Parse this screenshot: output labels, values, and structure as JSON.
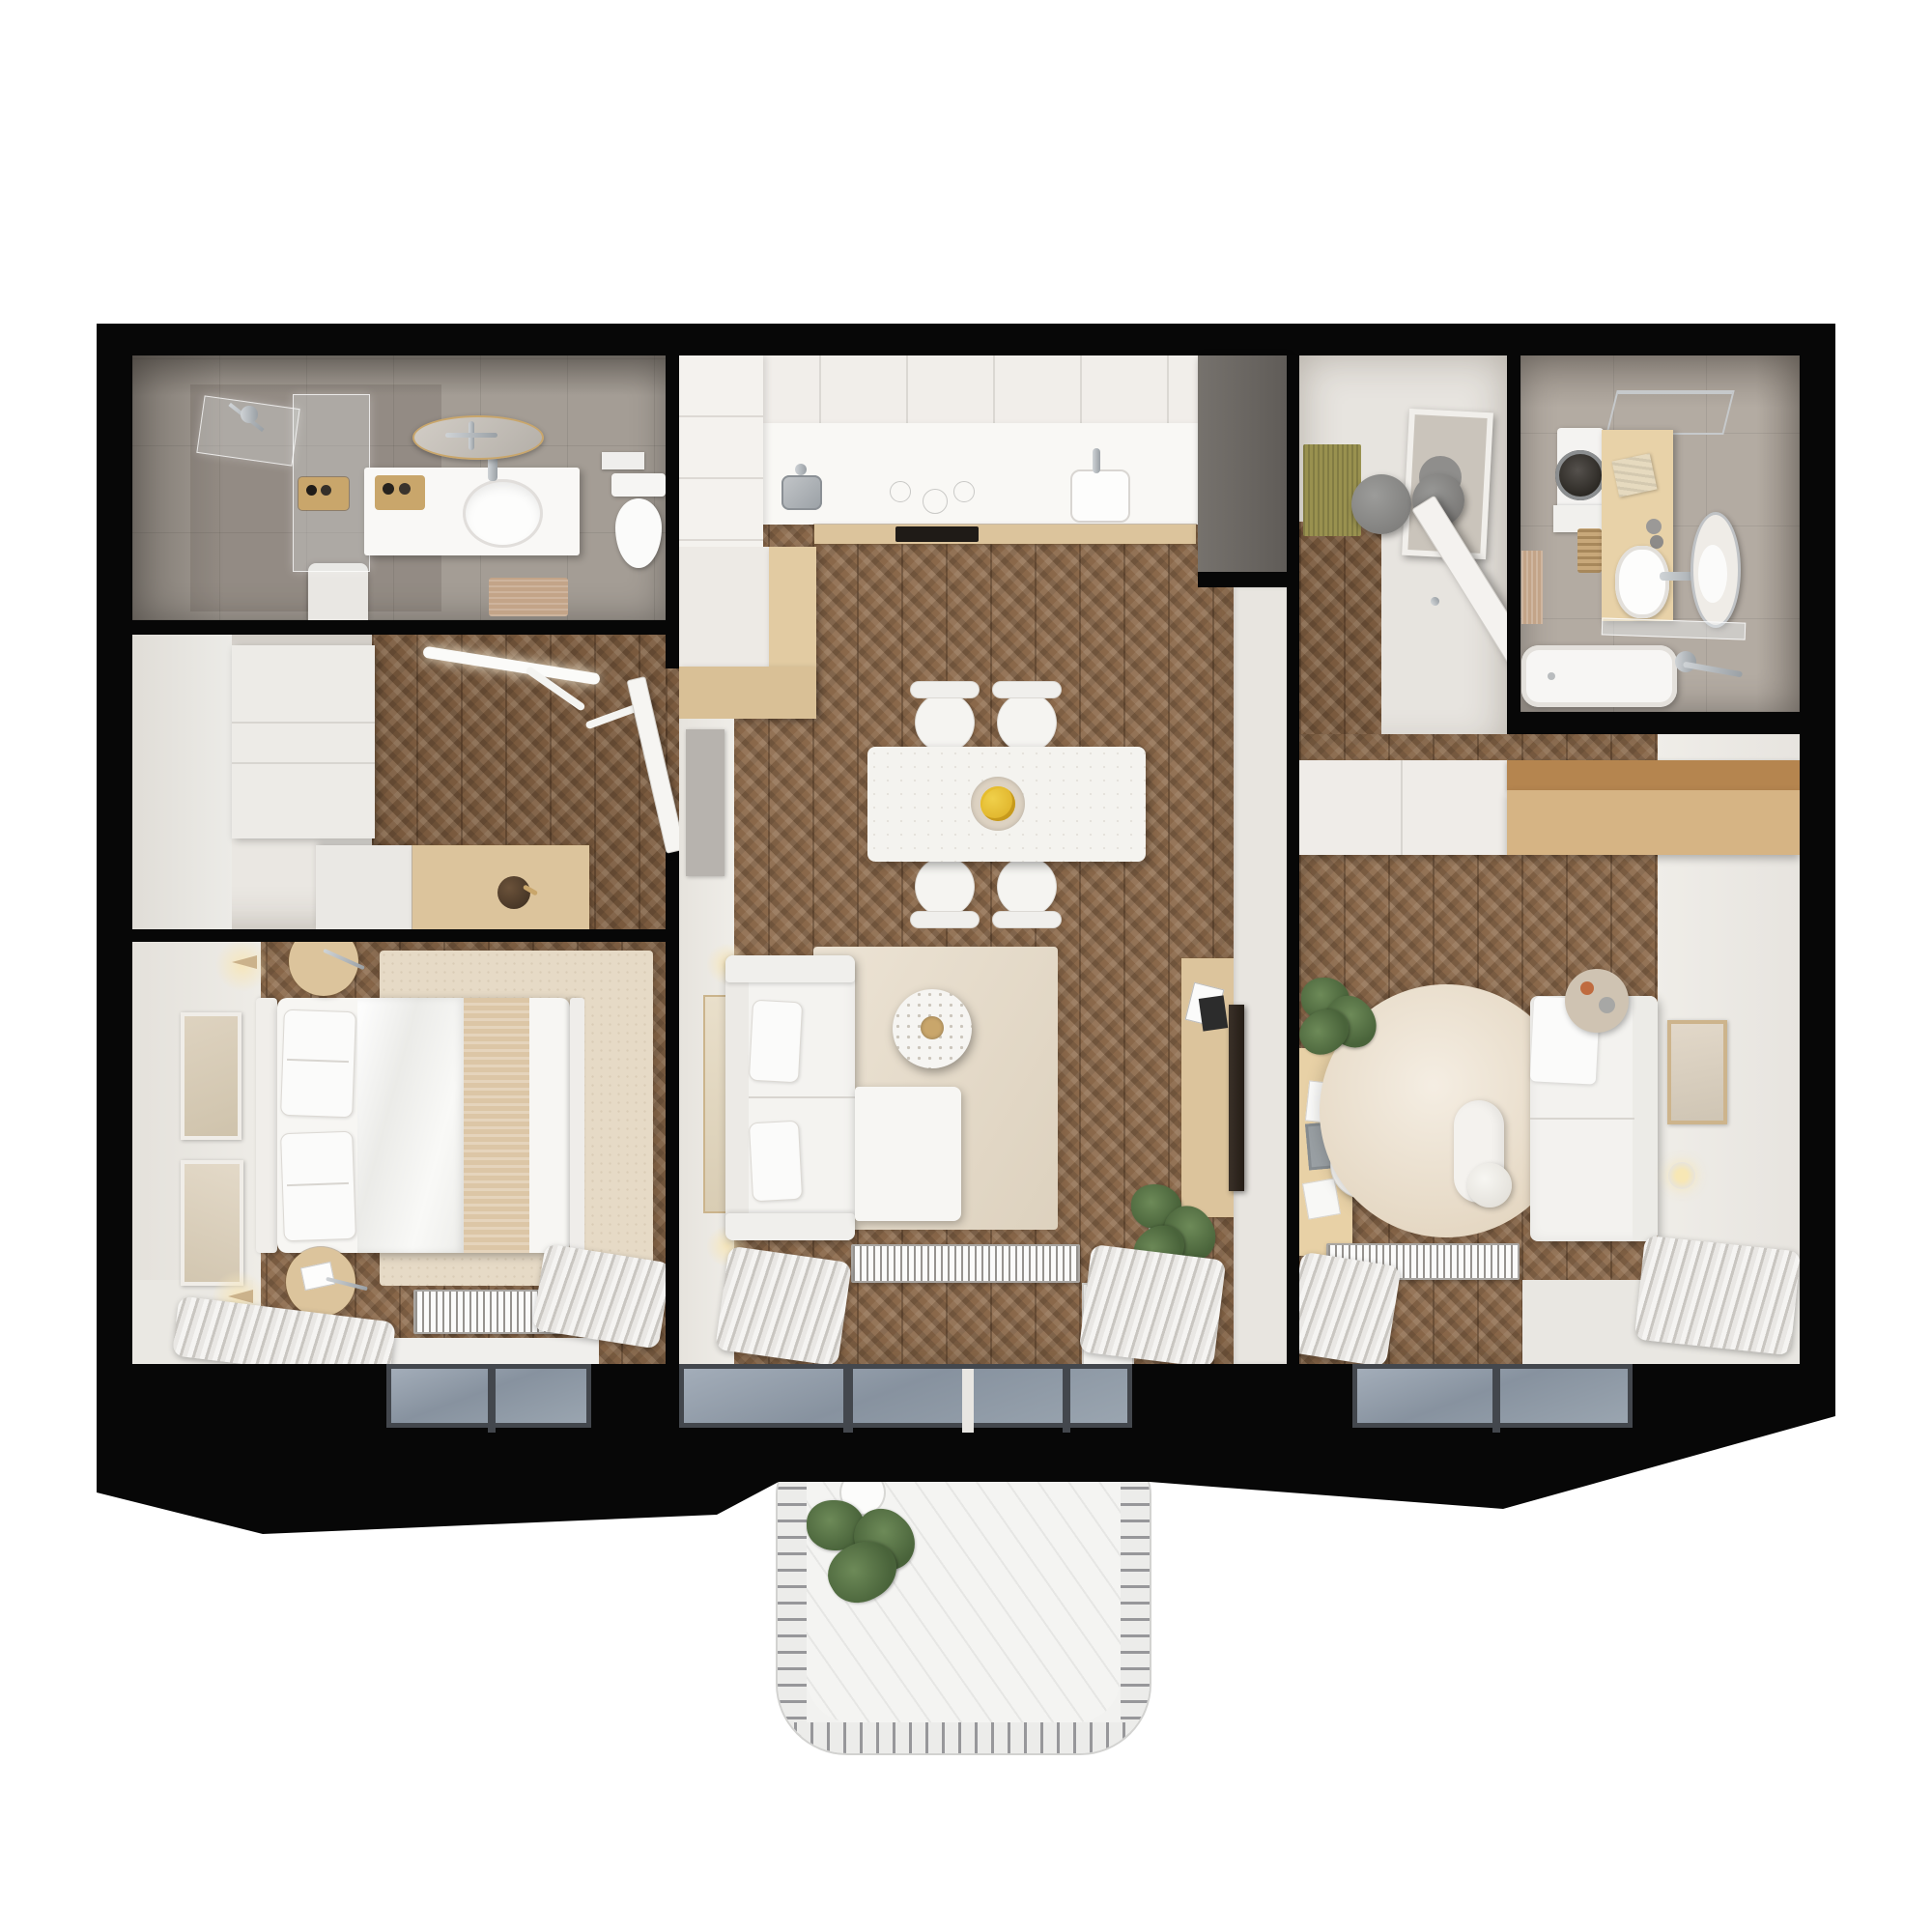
{
  "scene": {
    "type": "apartment floor plan – photorealistic top-down 3D render",
    "view": "top-down",
    "background": "#ffffff",
    "no_visible_text": true
  },
  "palette": {
    "wall": "#070707",
    "wood": "#8a684a",
    "woodDark": "#7a5a3e",
    "furnWood": "#dcc49c",
    "whiteWall": "#eae7e2",
    "counter": "#f9f8f5",
    "beigeCounter": "#e2cba2",
    "tileBath1": "#a49d95",
    "tileBath2": "#b3aba2",
    "rug": "#e6dac6",
    "rugRound": "#eadcc6",
    "glass": "#8e99a7",
    "radiator": "#fbfbfa",
    "curtain": "#d9d6d2",
    "grayWardrobe": "#6d6a66",
    "balcony": "#f2f2f0",
    "matOlive": "#99914f",
    "matTan": "#c3a488",
    "gold": "#c9a66b",
    "plantGreen": "#55703f",
    "lemon": "#e6bd2e",
    "terracotta": "#bf6b3f"
  },
  "rooms": [
    {
      "id": "bathroom-1",
      "label": "Bathroom 1 (top left)",
      "features": [
        "walk-in shower with glass panels",
        "white vanity with oval sink",
        "gold-rim round mirror",
        "wall-hung toilet",
        "shampoo trays",
        "tan bath mat",
        "gray tile floor"
      ]
    },
    {
      "id": "hallway-closet",
      "label": "Hallway / walk-in closet (middle left)",
      "features": [
        "white wardrobe",
        "white + oak sideboard with dark vase",
        "track ceiling light",
        "open door to living room",
        "chevron wood floor"
      ]
    },
    {
      "id": "bedroom-1",
      "label": "Bedroom 1 (bottom left)",
      "features": [
        "double bed with white duvet and beige runner",
        "two round oak nightstands",
        "beige rug",
        "two framed artworks",
        "two cone wall sconces",
        "radiator",
        "window with curtains"
      ]
    },
    {
      "id": "kitchen-living",
      "label": "Kitchen / living room (center)",
      "features": [
        "white tall cabinets",
        "counter with steel sink, induction hob, white basin, oven",
        "beige peninsula",
        "marble dining table with fruit bowl",
        "4 white chairs",
        "white sofa with chaise",
        "round terrazzo coffee table",
        "oak TV console with leaning TV",
        "plant",
        "gray wall panel",
        "tall wall art",
        "radiator",
        "balcony door"
      ]
    },
    {
      "id": "entry-hall",
      "label": "Entry hall (top center-right)",
      "features": [
        "anthracite wardrobe",
        "olive doormat",
        "two gray stools",
        "leaning mirror",
        "open front door"
      ]
    },
    {
      "id": "bathroom-2",
      "label": "Bathroom / laundry (top right)",
      "features": [
        "washing machine",
        "oak vanity with oval sink",
        "leaning oval mirror",
        "chrome towel rack",
        "towels",
        "laundry basket",
        "glass shelf",
        "bathtub with chrome mixer"
      ]
    },
    {
      "id": "bedroom-2",
      "label": "Bedroom 2 / office (bottom right)",
      "features": [
        "full-width wardrobe (white + oak)",
        "oak desk with laptop and papers",
        "white shell chair",
        "large round rug with bolster and ball cushion",
        "white daybed sofa",
        "round side table with cup",
        "framed art",
        "glowing wall lamp",
        "plant",
        "radiator",
        "window with curtains"
      ]
    },
    {
      "id": "balcony",
      "label": "Balcony (bottom center)",
      "features": [
        "rounded railing with bars",
        "plank floor",
        "potted plant",
        "white vase"
      ]
    }
  ],
  "structure": {
    "outer_walls": "thick black",
    "windows": [
      "bedroom-1 bottom",
      "living room bottom (balcony door)",
      "bedroom-2 bottom"
    ],
    "bottom_band": "black exterior wall band with beveled perspective edge"
  }
}
